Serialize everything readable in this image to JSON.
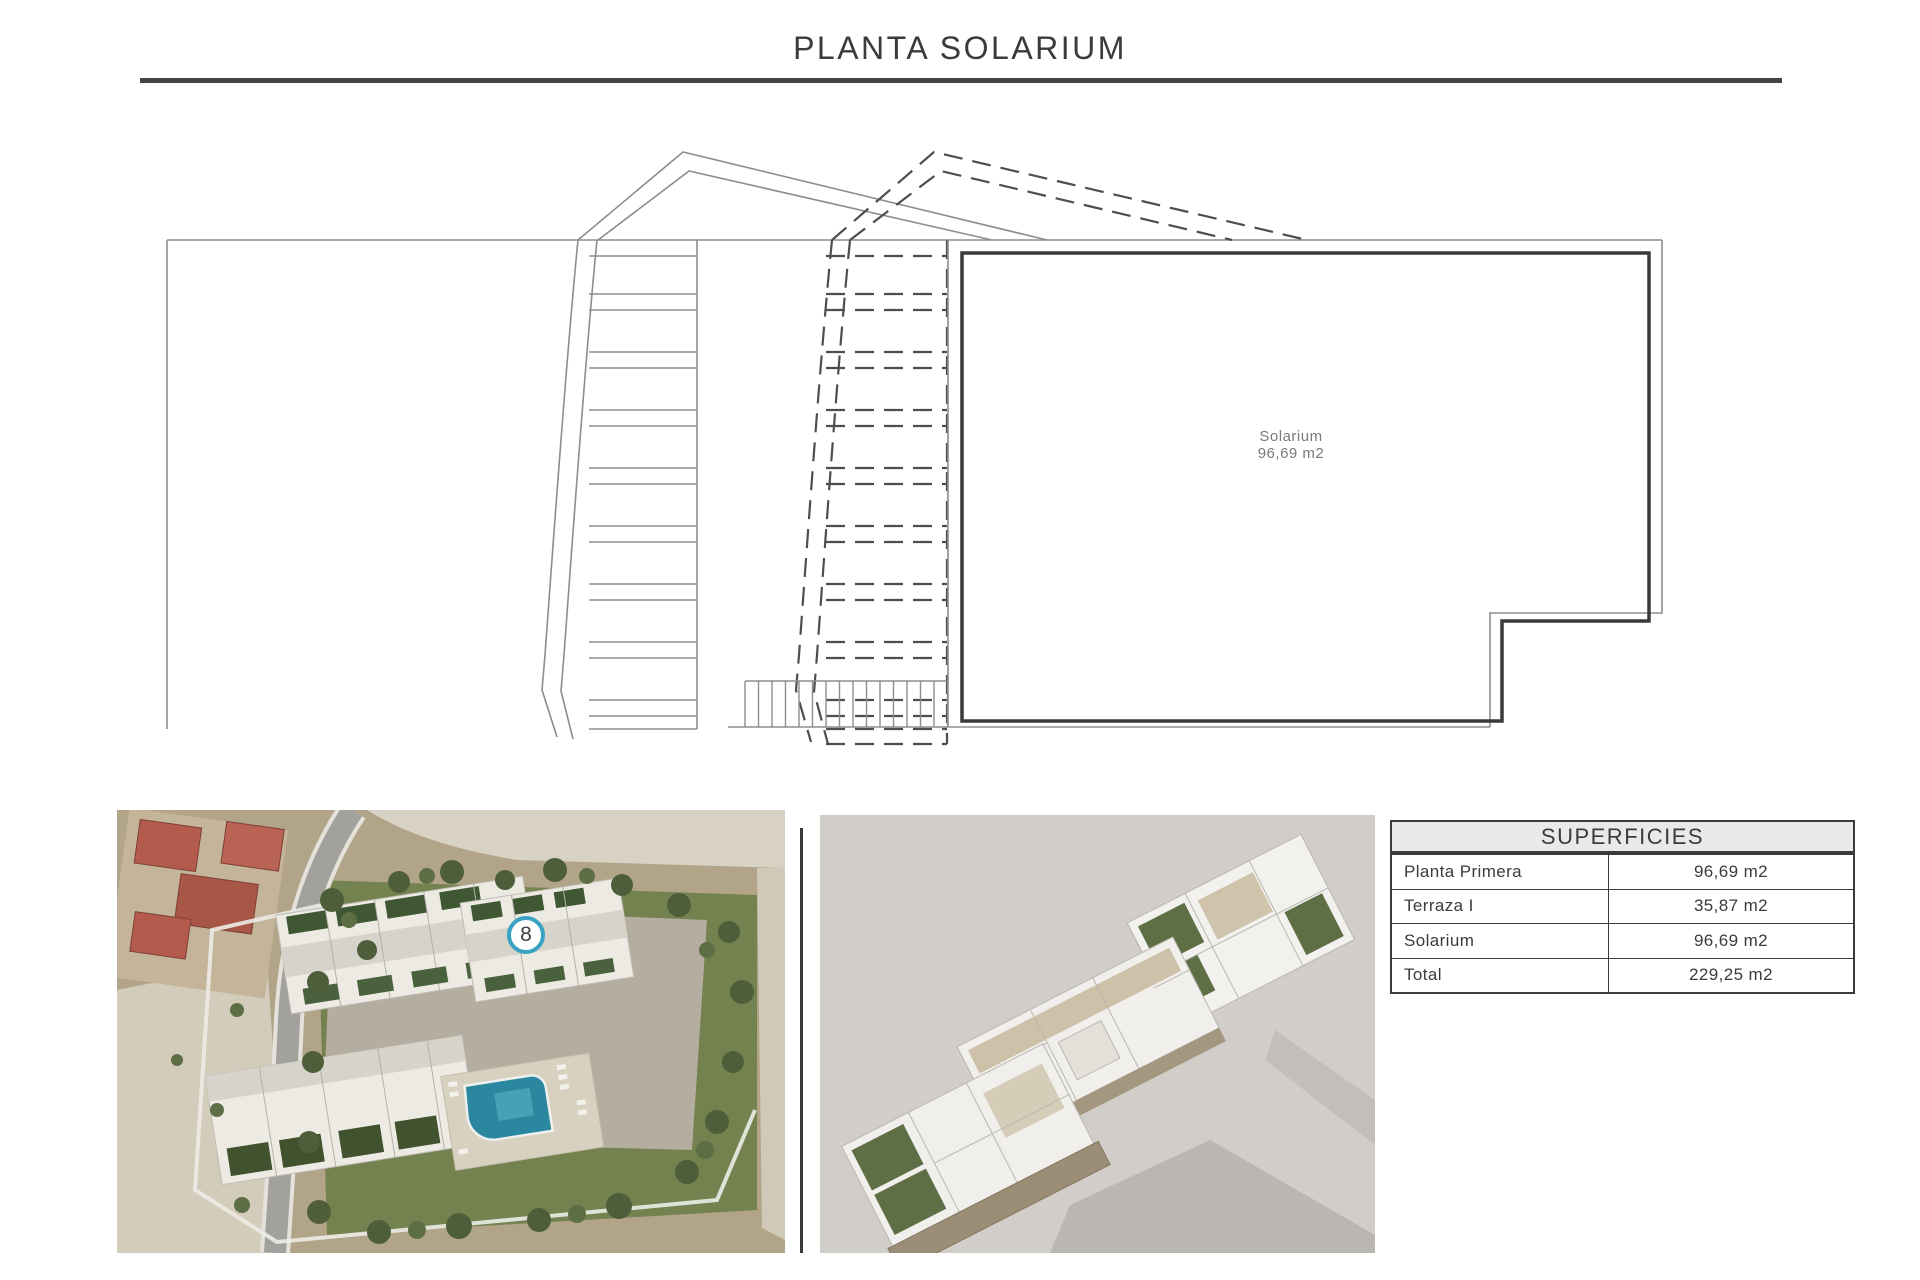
{
  "title": "PLANTA SOLARIUM",
  "plan": {
    "room_label": "Solarium",
    "room_area": "96,69 m2"
  },
  "badge": {
    "number": "8"
  },
  "table": {
    "header": "SUPERFICIES",
    "rows": [
      {
        "label": "Planta Primera",
        "value": "96,69 m2"
      },
      {
        "label": "Terraza I",
        "value": "35,87 m2"
      },
      {
        "label": "Solarium",
        "value": "96,69 m2"
      },
      {
        "label": "Total",
        "value": "229,25 m2"
      }
    ]
  },
  "colors": {
    "accent_blue": "#38a3c3",
    "line_dark": "#3a3a3a",
    "line_gray": "#8d8d8d",
    "table_header_bg": "#e9e9e9"
  }
}
